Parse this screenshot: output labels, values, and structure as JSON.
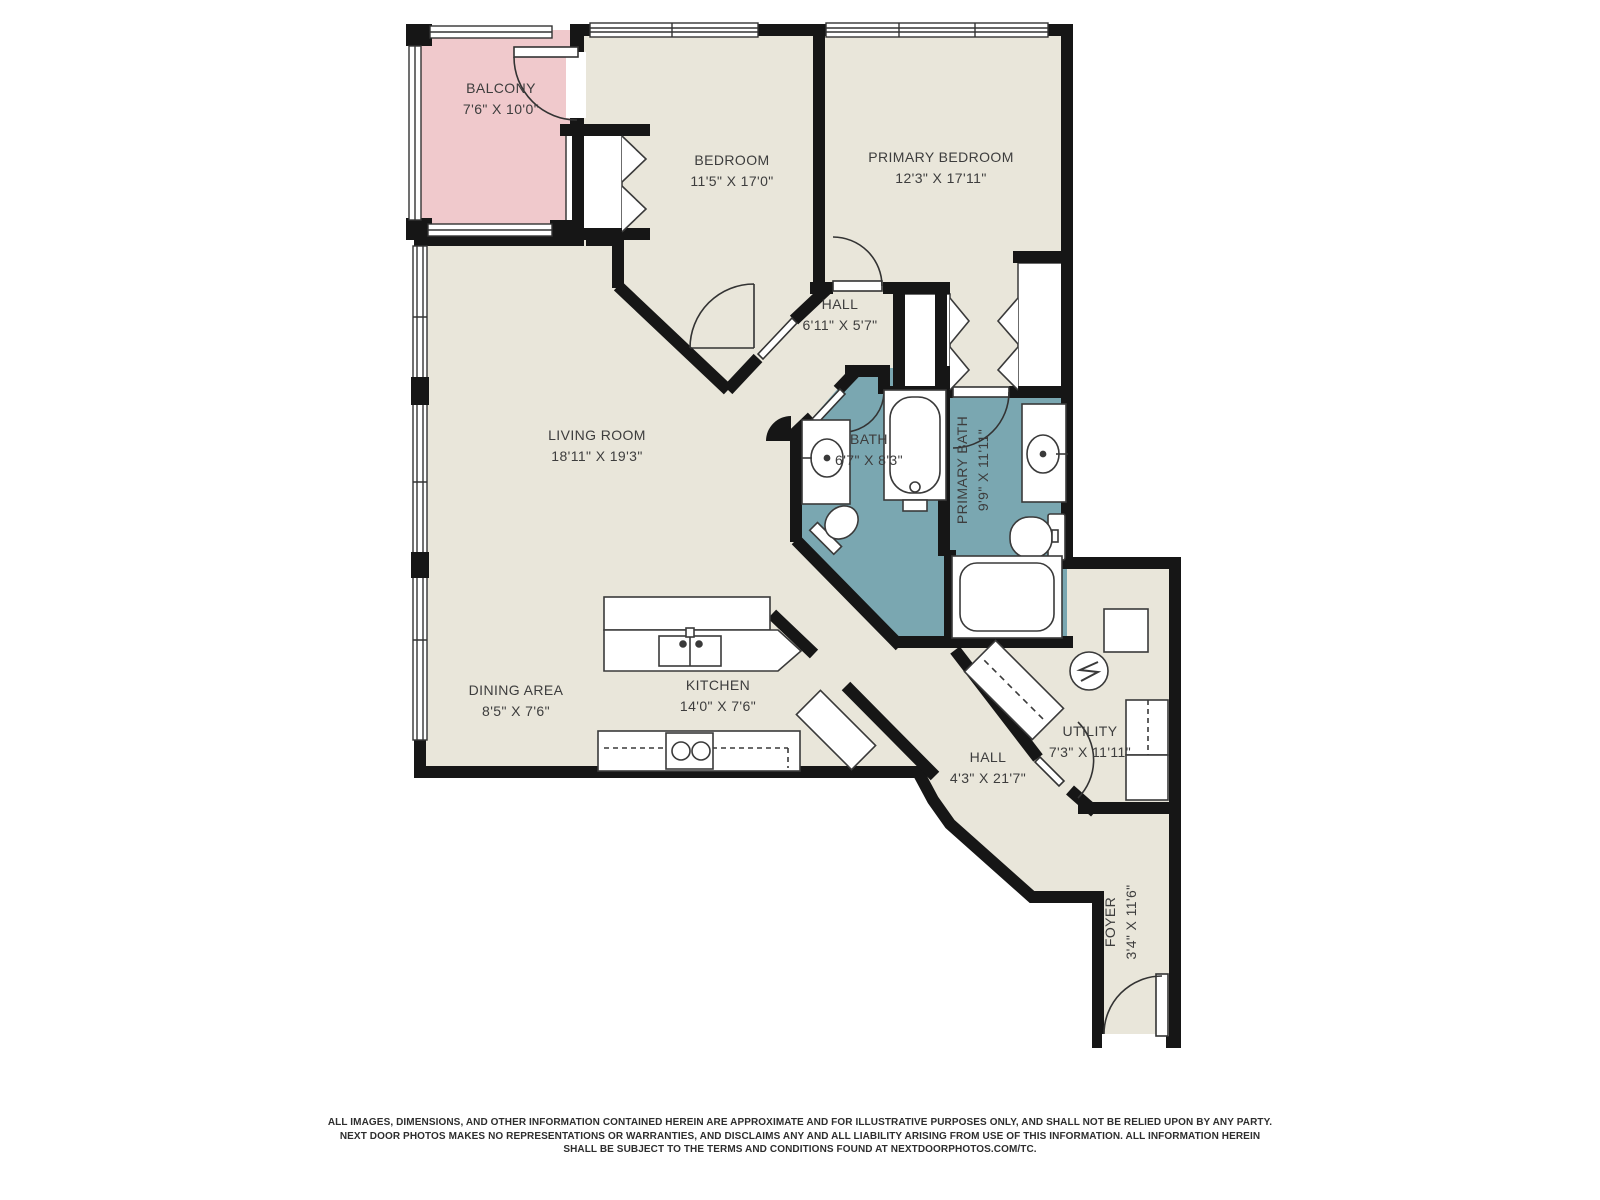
{
  "colors": {
    "floor": "#e9e6da",
    "balcony": "#f0c9cc",
    "water": "#7aa7b1",
    "wall": "#161616",
    "fixture_line": "#3a3a3a",
    "label_text": "#3d3d3d"
  },
  "rooms": {
    "balcony": {
      "name": "BALCONY",
      "dims": "7'6\" X 10'0\""
    },
    "bedroom": {
      "name": "BEDROOM",
      "dims": "11'5\" X 17'0\""
    },
    "primary_bedroom": {
      "name": "PRIMARY BEDROOM",
      "dims": "12'3\" X 17'11\""
    },
    "hall_upper": {
      "name": "HALL",
      "dims": "6'11\" X 5'7\""
    },
    "living_room": {
      "name": "LIVING ROOM",
      "dims": "18'11\" X 19'3\""
    },
    "bath": {
      "name": "BATH",
      "dims": "6'7\" X 8'3\""
    },
    "primary_bath": {
      "name": "PRIMARY BATH",
      "dims": "9'9\" X 11'11\""
    },
    "dining_area": {
      "name": "DINING AREA",
      "dims": "8'5\" X 7'6\""
    },
    "kitchen": {
      "name": "KITCHEN",
      "dims": "14'0\" X 7'6\""
    },
    "utility": {
      "name": "UTILITY",
      "dims": "7'3\" X 11'11\""
    },
    "hall_lower": {
      "name": "HALL",
      "dims": "4'3\" X 21'7\""
    },
    "foyer": {
      "name": "FOYER",
      "dims": "3'4\" X 11'6\""
    }
  },
  "fixtures": [
    "bathtub-icon",
    "shower-icon",
    "toilet-icon",
    "sink-icon",
    "kitchen-sink-icon",
    "cooktop-icon",
    "washer-dryer-icon",
    "water-heater-icon",
    "closet-bifold-icon",
    "door-swing-icon",
    "window-icon"
  ],
  "disclaimer": {
    "line1": "ALL IMAGES, DIMENSIONS, AND OTHER INFORMATION CONTAINED HEREIN ARE APPROXIMATE AND FOR ILLUSTRATIVE PURPOSES ONLY, AND SHALL NOT BE RELIED UPON BY ANY PARTY.",
    "line2": "NEXT DOOR PHOTOS MAKES NO REPRESENTATIONS OR WARRANTIES, AND DISCLAIMS ANY AND ALL LIABILITY ARISING FROM USE OF THIS INFORMATION. ALL INFORMATION HEREIN",
    "line3": "SHALL BE SUBJECT TO THE TERMS AND CONDITIONS FOUND AT NEXTDOORPHOTOS.COM/TC."
  }
}
